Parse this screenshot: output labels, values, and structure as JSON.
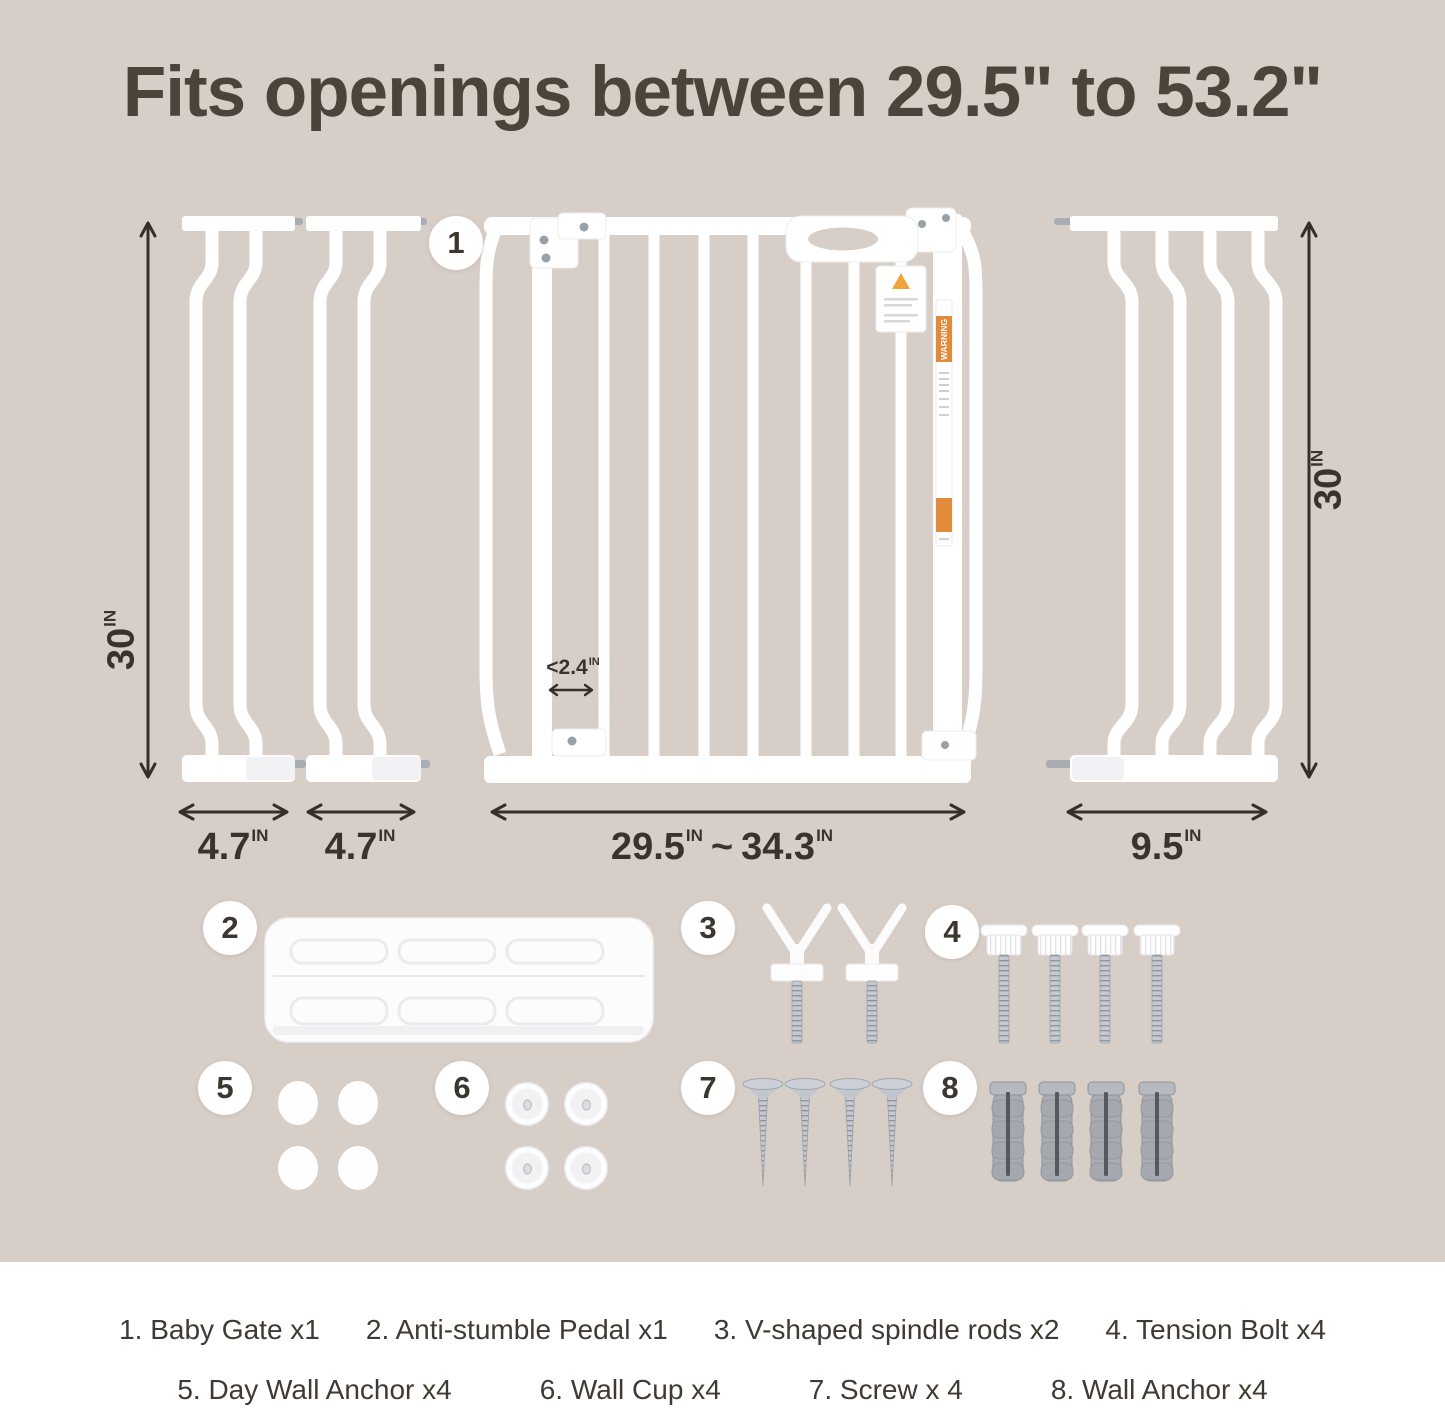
{
  "title": "Fits openings between 29.5\" to 53.2\"",
  "colors": {
    "background": "#d8cec8",
    "panel_white": "#ffffff",
    "text_dark": "#39332d",
    "warning_orange": "#e08a3c"
  },
  "markers": {
    "m1": "1",
    "m2": "2",
    "m3": "3",
    "m4": "4",
    "m5": "5",
    "m6": "6",
    "m7": "7",
    "m8": "8"
  },
  "measurements": {
    "height_left": {
      "value": "30",
      "unit": "IN"
    },
    "height_right": {
      "value": "30",
      "unit": "IN"
    },
    "ext_left_1": {
      "value": "4.7",
      "unit": "IN"
    },
    "ext_left_2": {
      "value": "4.7",
      "unit": "IN"
    },
    "gate_min": {
      "value": "29.5",
      "unit": "IN"
    },
    "gate_separator": "~",
    "gate_max": {
      "value": "34.3",
      "unit": "IN"
    },
    "ext_right": {
      "value": "9.5",
      "unit": "IN"
    },
    "bar_gap": {
      "value": "<2.4",
      "unit": "IN"
    }
  },
  "gate_labels": {
    "warning_strip": "WARNING"
  },
  "legend": {
    "row1": [
      "1. Baby Gate x1",
      "2. Anti-stumble Pedal x1",
      "3. V-shaped spindle rods x2",
      "4. Tension Bolt x4"
    ],
    "row2": [
      "5. Day Wall Anchor x4",
      "6. Wall Cup x4",
      "7. Screw x 4",
      "8. Wall Anchor x4"
    ]
  }
}
